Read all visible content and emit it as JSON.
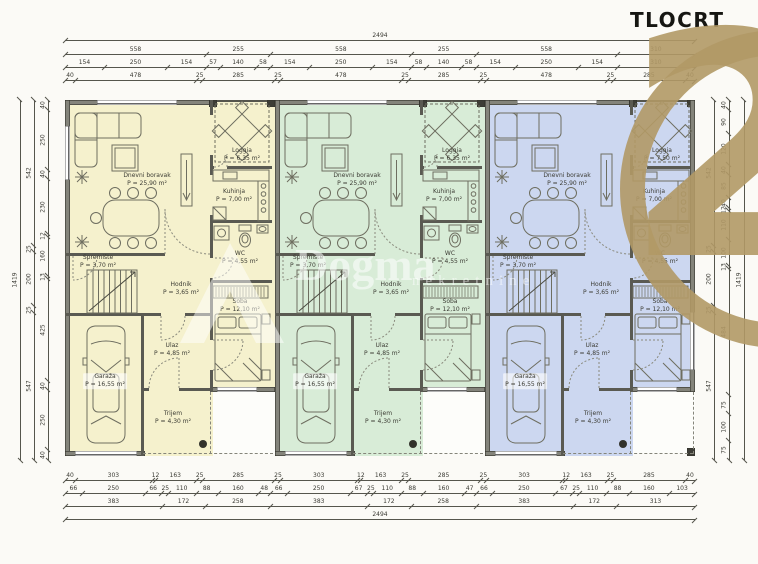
{
  "title": {
    "text": "TLOCRT"
  },
  "watermarks": {
    "century21": {
      "number": "21",
      "color": "#b19a69"
    },
    "dogma": {
      "name": "Dogma",
      "subtitle": "nekretnine"
    }
  },
  "dimensions": {
    "top": {
      "total": "2494",
      "sections": [
        "558",
        "255",
        "558",
        "255",
        "558",
        "310"
      ],
      "detail": [
        "154",
        "250",
        "154",
        "57",
        "140",
        "58",
        "154",
        "250",
        "154",
        "58",
        "140",
        "58",
        "154",
        "250",
        "154",
        "310"
      ],
      "fine": [
        "40",
        "478",
        "25",
        "285",
        "25",
        "478",
        "25",
        "285",
        "25",
        "478",
        "25",
        "285",
        "40"
      ]
    },
    "bottom": {
      "fine": [
        "40",
        "303",
        "12",
        "163",
        "25",
        "285",
        "25",
        "303",
        "12",
        "163",
        "25",
        "285",
        "25",
        "303",
        "12",
        "163",
        "25",
        "285",
        "40"
      ],
      "detail": [
        "66",
        "250",
        "66",
        "25",
        "110",
        "88",
        "160",
        "48",
        "66",
        "250",
        "67",
        "25",
        "110",
        "88",
        "160",
        "47",
        "66",
        "250",
        "67",
        "25",
        "110",
        "88",
        "160",
        "103"
      ],
      "sections": [
        "383",
        "172",
        "258",
        "383",
        "172",
        "258",
        "383",
        "172",
        "313"
      ],
      "total": "2494"
    },
    "left": {
      "total": "1419",
      "sections": [
        "542",
        "25",
        "200",
        "25",
        "547"
      ],
      "fine": [
        "40",
        "250",
        "40",
        "230",
        "12",
        "160",
        "13",
        "425",
        "40",
        "250",
        "40"
      ]
    },
    "right": {
      "total": "1419",
      "sections": [
        "542",
        "25",
        "200",
        "25",
        "547"
      ],
      "fine": [
        "40",
        "90",
        "120",
        "40",
        "85",
        "40",
        "12",
        "110",
        "100",
        "13",
        "484",
        "75",
        "100",
        "75"
      ]
    }
  },
  "units": [
    {
      "id": "a",
      "fill": "#f5f1cd",
      "rooms": {
        "dnevni_boravak": {
          "name": "Dnevni boravak",
          "area": "P = 25,90 m²"
        },
        "loggia": {
          "name": "Loggia",
          "area": "P = 6,35 m²"
        },
        "kuhinja": {
          "name": "Kuhinja",
          "area": "P = 7,00 m²"
        },
        "wc": {
          "name": "WC",
          "area": "P = 4,55 m²"
        },
        "spremiste": {
          "name": "Spremište",
          "area": "P = 3,70 m²"
        },
        "hodnik": {
          "name": "Hodnik",
          "area": "P = 3,65 m²"
        },
        "soba": {
          "name": "Soba",
          "area": "P = 12,10 m²"
        },
        "ulaz": {
          "name": "Ulaz",
          "area": "P = 4,85 m²"
        },
        "garaza": {
          "name": "Garaža",
          "area": "P = 16,55 m²"
        },
        "trijem": {
          "name": "Trijem",
          "area": "P = 4,30 m²"
        }
      }
    },
    {
      "id": "b",
      "fill": "#d8ecd7",
      "rooms": {
        "dnevni_boravak": {
          "name": "Dnevni boravak",
          "area": "P = 25,90 m²"
        },
        "loggia": {
          "name": "Loggia",
          "area": "P = 6,35 m²"
        },
        "kuhinja": {
          "name": "Kuhinja",
          "area": "P = 7,00 m²"
        },
        "wc": {
          "name": "WC",
          "area": "P = 4,55 m²"
        },
        "spremiste": {
          "name": "Spremište",
          "area": "P = 3,70 m²"
        },
        "hodnik": {
          "name": "Hodnik",
          "area": "P = 3,65 m²"
        },
        "soba": {
          "name": "Soba",
          "area": "P = 12,10 m²"
        },
        "ulaz": {
          "name": "Ulaz",
          "area": "P = 4,85 m²"
        },
        "garaza": {
          "name": "Garaža",
          "area": "P = 16,55 m²"
        },
        "trijem": {
          "name": "Trijem",
          "area": "P = 4,30 m²"
        }
      }
    },
    {
      "id": "c",
      "fill": "#ccd7f0",
      "rooms": {
        "dnevni_boravak": {
          "name": "Dnevni boravak",
          "area": "P = 25,90 m²"
        },
        "loggia": {
          "name": "Loggia",
          "area": "P = 7,50 m²"
        },
        "kuhinja": {
          "name": "Kuhinja",
          "area": "P = 7,00 m²"
        },
        "wc": {
          "name": "WC",
          "area": "P = 4,55 m²"
        },
        "spremiste": {
          "name": "Spremište",
          "area": "P = 3,70 m²"
        },
        "hodnik": {
          "name": "Hodnik",
          "area": "P = 3,65 m²"
        },
        "soba": {
          "name": "Soba",
          "area": "P = 12,10 m²"
        },
        "ulaz": {
          "name": "Ulaz",
          "area": "P = 4,85 m²"
        },
        "garaza": {
          "name": "Garaža",
          "area": "P = 16,55 m²"
        },
        "trijem": {
          "name": "Trijem",
          "area": "P = 4,30 m²"
        }
      }
    }
  ]
}
